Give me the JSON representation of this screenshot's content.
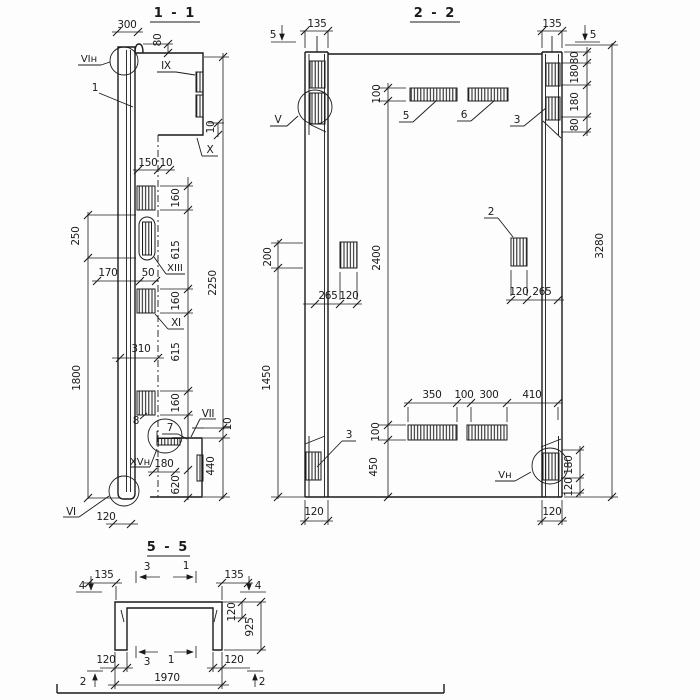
{
  "s11": {
    "title": "1 - 1",
    "labels": {
      "vin": "VIн",
      "n1": "1",
      "ix": "IX",
      "x": "X",
      "xiii": "XIII",
      "xi": "XI",
      "n8": "8",
      "n7": "7",
      "vii": "VII",
      "xvn": "XVн",
      "vi": "VI"
    },
    "dims": {
      "d300": "300",
      "d80": "80",
      "d10_top": "10",
      "d150": "150",
      "d10_mid": "10",
      "d250": "250",
      "d170": "170",
      "d50": "50",
      "d160_1": "160",
      "d615_1": "615",
      "d160_2": "160",
      "d615_2": "615",
      "d160_3": "160",
      "d2250": "2250",
      "d310": "310",
      "d1800": "1800",
      "d180": "180",
      "d620": "620",
      "d440": "440",
      "d10_bot": "10",
      "d120": "120"
    }
  },
  "s22": {
    "title": "2 - 2",
    "labels": {
      "v": "V",
      "n5": "5",
      "n6": "6",
      "n3_t": "3",
      "n2": "2",
      "n3_b": "3",
      "vn": "Vн"
    },
    "marks": {
      "cut5_l": "5",
      "cut5_r": "5"
    },
    "dims": {
      "d135_l": "135",
      "d135_r": "135",
      "d80_1": "80",
      "d180_1": "180",
      "d180_2": "180",
      "d80_2": "80",
      "d3280": "3280",
      "d100_t": "100",
      "d2400": "2400",
      "d100_b": "100",
      "d450": "450",
      "d200": "200",
      "d1450": "1450",
      "d265_l": "265",
      "d120_l1": "120",
      "d120_r1": "120",
      "d265_r": "265",
      "d350": "350",
      "d100_m": "100",
      "d300": "300",
      "d410": "410",
      "d180_b": "180",
      "d120_b": "120",
      "d120_cl": "120",
      "d120_cr": "120"
    }
  },
  "s55": {
    "title": "5 - 5",
    "marks": {
      "c4_l": "4",
      "c4_r": "4",
      "c3_t": "3",
      "c1_t": "1",
      "c3_b": "3",
      "c1_b": "1",
      "c2_l": "2",
      "c2_r": "2"
    },
    "dims": {
      "d135_l": "135",
      "d135_r": "135",
      "d120_t": "120",
      "d925": "925",
      "d120_l": "120",
      "d120_r": "120",
      "d1970": "1970"
    }
  }
}
